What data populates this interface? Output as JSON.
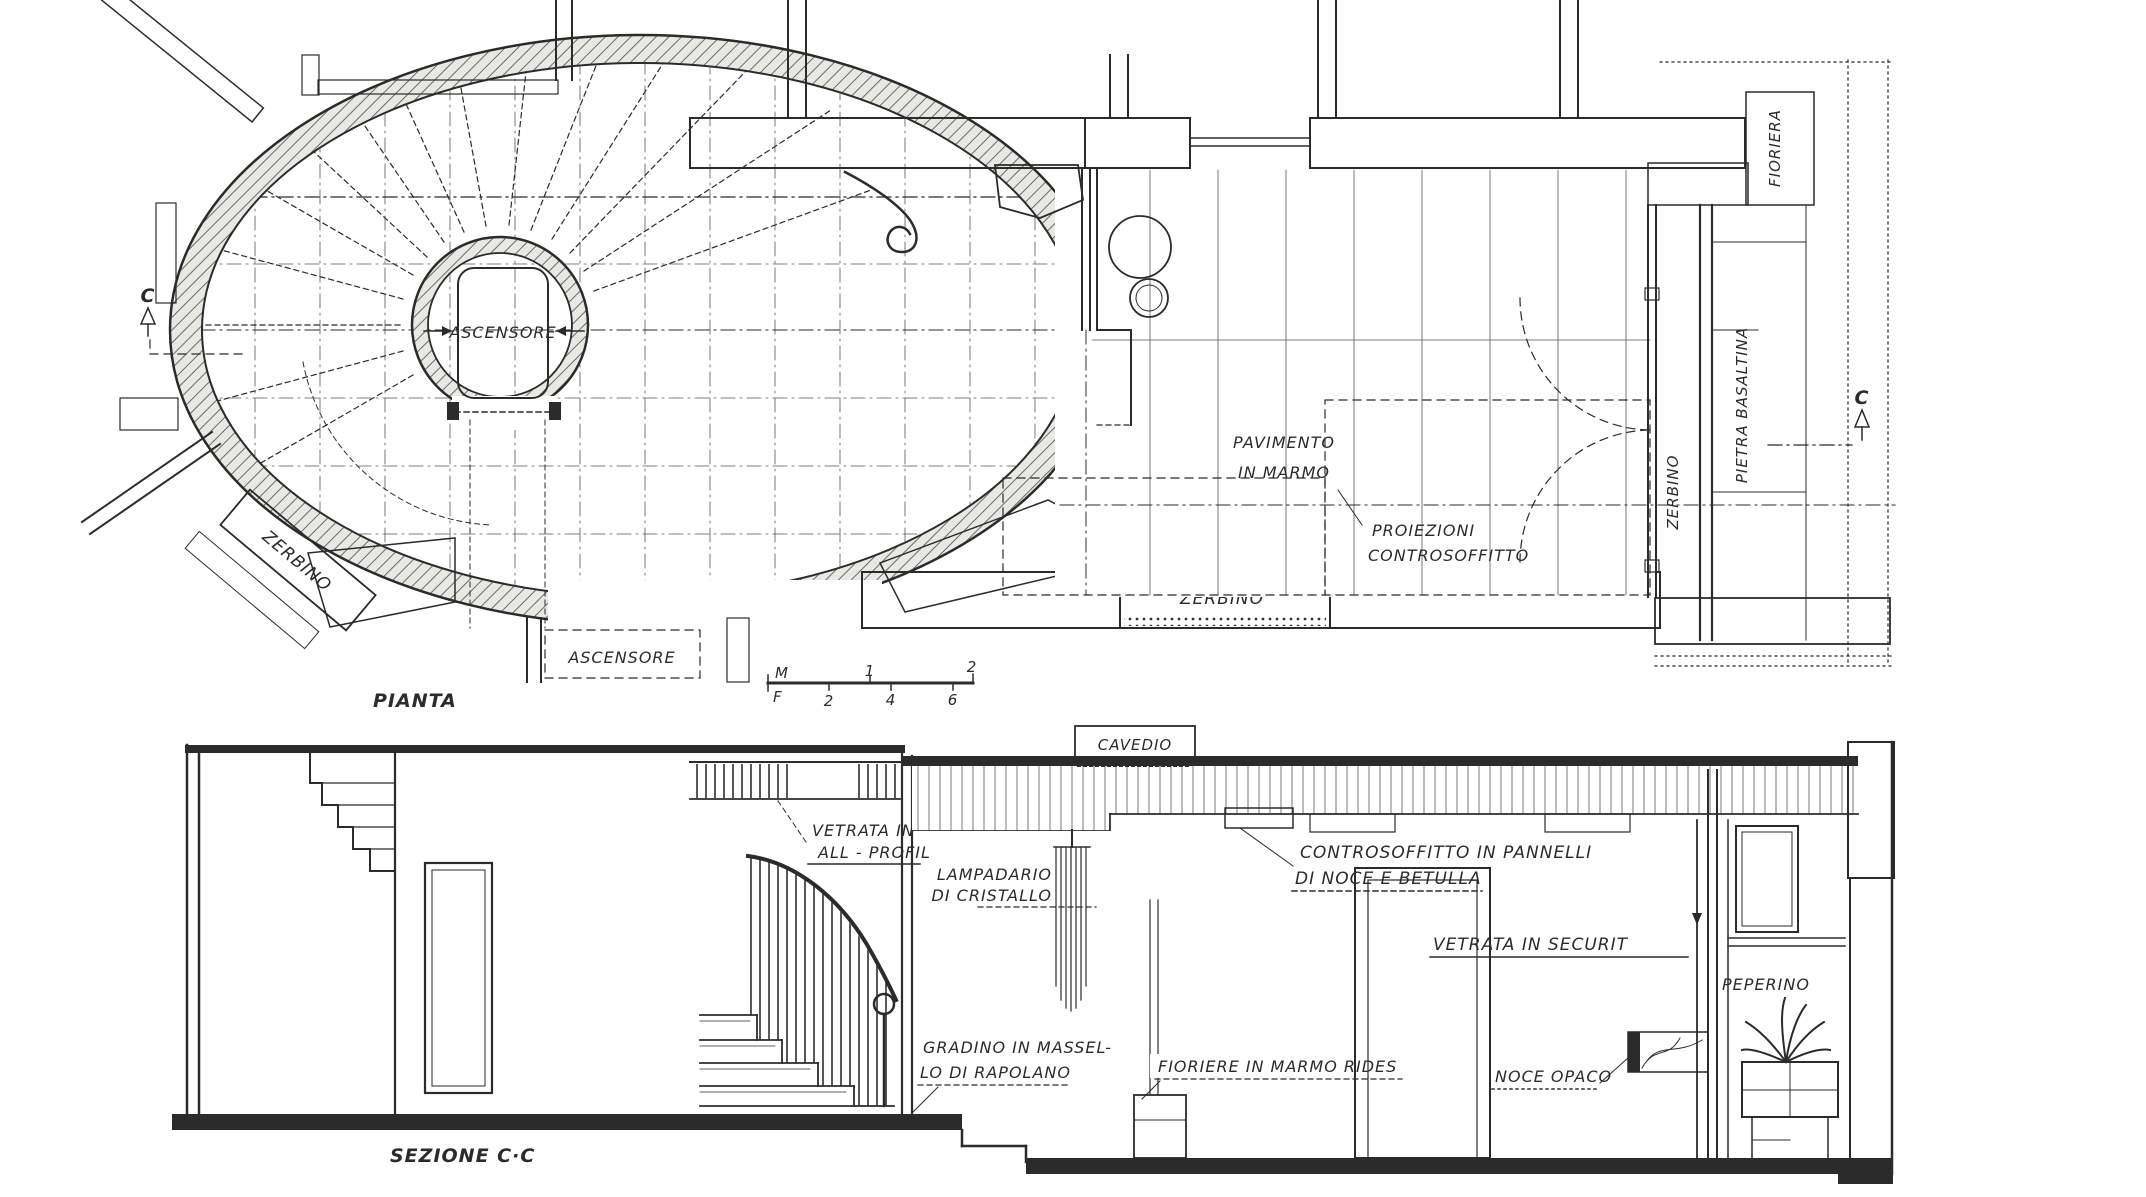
{
  "plan": {
    "title": "PIANTA",
    "elevator_label": "ASCENSORE",
    "elevator_lower_label": "ASCENSORE",
    "floor_label_line1": "PAVIMENTO",
    "floor_label_line2": "IN  MARMO",
    "ceiling_projection_line1": "PROIEZIONI",
    "ceiling_projection_line2": "CONTROSOFFITTO",
    "doormat_diagonal": "ZERBINO",
    "doormat_bottom": "ZERBINO",
    "doormat_right": "ZERBINO",
    "stone_strip": "PIETRA  BASALTINA",
    "planter_strip": "FIORIERA",
    "section_marker_left": "C",
    "section_marker_right": "C",
    "scale_bar": {
      "meters_unit": "M",
      "feet_unit": "F",
      "m1": "1",
      "m2": "2",
      "f2": "2",
      "f4": "4",
      "f6": "6"
    }
  },
  "section": {
    "title": "SEZIONE  C·C",
    "cavedio": "CAVEDIO",
    "vetrata_profil_line1": "VETRATA IN",
    "vetrata_profil_line2": "ALL - PROFIL",
    "lampadario_line1": "LAMPADARIO",
    "lampadario_line2": "DI CRISTALLO",
    "controsoffitto_line1": "CONTROSOFFITTO IN PANNELLI",
    "controsoffitto_line2": "DI NOCE E BETULLA",
    "vetrata_securit": "VETRATA IN SECURIT",
    "gradino_line1": "GRADINO IN MASSEL-",
    "gradino_line2": "LO DI RAPOLANO",
    "fioriere": "FIORIERE IN MARMO RIDES",
    "noce_opaco": "NOCE OPACO",
    "peperino": "PEPERINO"
  },
  "colors": {
    "ink": "#2b2b2b",
    "paper": "#ffffff",
    "wall_hatch_fill": "#e8e8e4",
    "dark_pier_fill": "#a8a8a2"
  }
}
